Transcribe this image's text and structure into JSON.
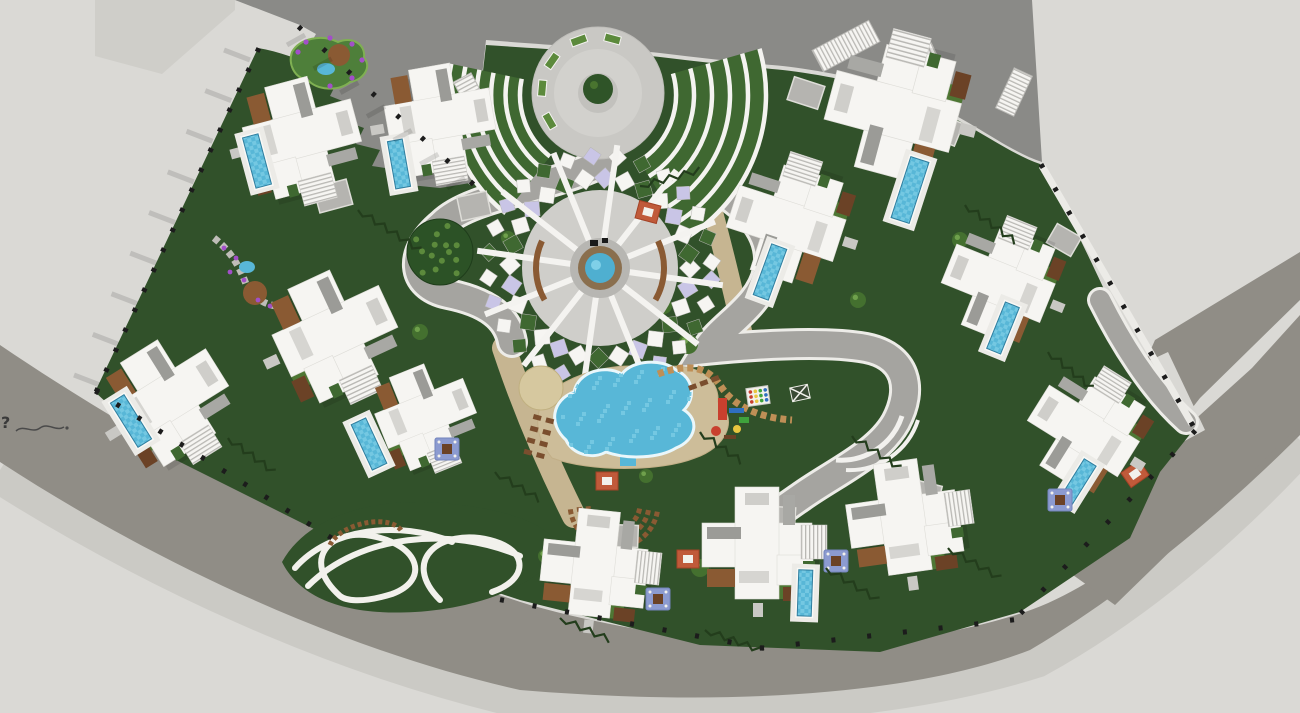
{
  "meta": {
    "view": "aerial-site-plan",
    "description": "Top-down 3D render of a fan-shaped villa resort master plan with central clubhouse, lagoon pool, playground, entry plaza and perimeter ring roads"
  },
  "annotation": {
    "stray_text": "?"
  },
  "palette": {
    "ground": "#DAD9D5",
    "paved_tl": "#CFCEC9",
    "road_dark": "#8A8A87",
    "road_bottom": "#908D86",
    "road_mid": "#A5A4A0",
    "road_light": "#CBCAC5",
    "green": "#31512A",
    "lawn": "#4E7734",
    "lawn_bright": "#5C8A3C",
    "planting": "#3F6831",
    "white": "#F6F5F2",
    "roof_gray": "#CFCECA",
    "roof_dark": "#9B9B97",
    "wall_white": "#ECEBE7",
    "pool": "#58B7D7",
    "pool_light": "#74C8E2",
    "pool_edge": "#2F7D9E",
    "sand": "#CDBD99",
    "tan_path": "#C6B591",
    "deck": "#8A5A33",
    "deck_dark": "#6B4226",
    "hedge": "#233D1C",
    "purple": "#A24FC8",
    "lavender": "#C9C5E6",
    "red": "#C8402E",
    "blue": "#2F6FBF",
    "ply_green": "#3FA23C",
    "yellow": "#E8C63F",
    "fence": "#1C1C1C",
    "jacuzzi": "#8C9BD0",
    "cabana": "#C05A3A"
  },
  "scene": {
    "paved_tl_d": "M95,0 L235,0 L235,10 L162,74 L95,56 Z",
    "roads": {
      "top_d": "M235,0 L1032,0 L1042,162 C1004,150 962,112 908,94 C856,76 806,68 772,65 C738,62 700,58 660,53 C620,49 560,46 486,40 L470,183 L440,188 L420,186 L392,184 L398,170 L372,166 L380,150 L356,144 L364,128 L342,120 L350,104 L330,96 L338,80 L318,72 L326,57 L308,48 L316,34 L300,25 Z",
      "bottom_d": "M0,345 C170,460 340,545 530,605 C700,652 880,660 1025,612 C1135,575 1235,455 1300,390 L1300,435 C1240,495 1140,585 1030,650 C900,700 700,705 520,690 C340,650 150,560 0,462 Z",
      "shoulder_d": "M0,470 C150,565 330,650 520,695 C700,712 900,698 1035,655 C1150,592 1245,500 1300,440",
      "diag_bands": [
        [
          [
            1155,
            340
          ],
          [
            1300,
            252
          ],
          [
            1300,
            300
          ],
          [
            1200,
            398
          ],
          [
            1085,
            545
          ],
          [
            1078,
            515
          ]
        ],
        [
          [
            1252,
            368
          ],
          [
            1300,
            315
          ],
          [
            1300,
            425
          ],
          [
            1115,
            605
          ],
          [
            1045,
            555
          ]
        ]
      ],
      "driveway_pad": [
        [
          1108,
          380
        ],
        [
          1168,
          352
        ],
        [
          1205,
          430
        ],
        [
          1135,
          468
        ]
      ],
      "inner": [
        {
          "d": "M600,164 C545,190 470,196 442,224 C408,252 410,286 448,294 C488,302 508,318 512,342",
          "w": 26
        },
        {
          "d": "M666,164 C738,192 776,228 768,270 C760,308 722,324 706,350 C744,346 822,340 866,348 C906,356 914,388 896,422 C878,454 836,472 802,496 C782,510 770,518 758,530",
          "w": 26
        },
        {
          "d": "M1100,300 C1120,340 1150,390 1186,422",
          "w": 20
        }
      ],
      "curbs": [
        {
          "d": "M836,460 A64,64 0 0 0 902,416",
          "w": 5
        },
        {
          "d": "M846,470 A72,72 0 0 0 918,420",
          "w": 4
        }
      ]
    },
    "site": {
      "green_d": "M258,48 C330,60 400,120 470,185 L486,45 C560,50 620,53 660,57 C700,62 740,66 772,69 C806,72 856,80 908,98 C962,116 1004,152 1040,164 C1062,200 1092,262 1125,335 L1195,428 L1160,472 L1130,538 L1020,612 L880,652 L700,645 L520,600 L330,537 L160,452 L95,392 Z",
      "island_d": "M282,562 C310,512 380,498 440,503 C505,508 545,522 562,548 C540,585 480,608 415,612 C345,616 300,598 282,562 Z",
      "island_loops": [
        "M295,568 C330,528 400,520 452,542",
        "M308,586 C360,534 452,526 520,556",
        "M340,596 C300,560 330,528 372,536 C420,545 430,580 392,594 C360,604 345,600 340,596",
        "M440,600 C400,560 440,528 490,540 C530,550 528,580 492,592"
      ],
      "island_arc": "M330,545 A38,20 -15 0 1 402,532",
      "east_wall": [
        1042,
        166,
        1192,
        424
      ]
    },
    "plaza": {
      "cx": 598,
      "cy": 93,
      "r": 66,
      "planter_angles": [
        150,
        185,
        215,
        250,
        285
      ]
    },
    "wings": [
      {
        "cx": 598,
        "cy": 95,
        "a0": 128,
        "a1": 192,
        "r0": 78,
        "r1": 150,
        "n": 5
      },
      {
        "cx": 598,
        "cy": 95,
        "a0": -16,
        "a1": 58,
        "r0": 78,
        "r1": 168,
        "n": 5
      }
    ],
    "clubhouse": {
      "cx": 600,
      "cy": 268,
      "r_ground": 78,
      "spokes": 12,
      "tile_step": 13
    },
    "lagoon": {
      "sand_d": "M552,458 C530,430 534,400 560,385 C585,370 620,362 655,368 C695,360 720,378 718,402 C740,420 725,448 695,458 C660,472 590,472 552,458 Z",
      "pool_d": "M566,440 C548,424 552,400 574,392 C578,372 604,364 622,374 C632,360 662,358 676,370 C694,378 696,398 684,410 C700,420 696,440 676,448 C660,458 628,460 606,452 C592,460 572,454 566,440 Z",
      "stub": [
        620,
        448,
        16,
        18
      ],
      "patio": [
        541,
        388,
        22
      ]
    },
    "promenades": [
      {
        "d": "M504,348 C522,402 544,456 574,516",
        "w": 24
      },
      {
        "d": "M702,174 C716,220 728,268 744,340",
        "w": 20
      }
    ],
    "trail": {
      "d": "M658,374 C696,360 712,372 722,388 C736,408 762,418 792,420",
      "w": 7
    },
    "sun_deck": {
      "cx": 614,
      "cy": 504,
      "radii": [
        26,
        35,
        44
      ],
      "a0": 10,
      "a1": 175
    },
    "gardens": {
      "tl_blob_d": "M292,52 C300,38 322,34 338,42 C352,36 366,44 364,58 C372,66 364,80 350,82 C338,92 316,90 308,80 C294,78 288,64 292,52 Z",
      "tl_pond": [
        326,
        69,
        9,
        6
      ],
      "tl_mulch": [
        339,
        55,
        11
      ],
      "tl_flowers": [
        [
          298,
          52
        ],
        [
          306,
          42
        ],
        [
          330,
          38
        ],
        [
          352,
          44
        ],
        [
          362,
          60
        ],
        [
          352,
          78
        ],
        [
          330,
          86
        ],
        [
          306,
          80
        ]
      ],
      "left_stone_d": "M214,238 C232,252 240,268 246,284 C254,300 270,308 286,306",
      "left_pond": [
        247,
        267,
        8,
        6
      ],
      "left_mulch": [
        255,
        293,
        12
      ],
      "left_flowers": [
        [
          224,
          248
        ],
        [
          236,
          258
        ],
        [
          230,
          272
        ],
        [
          244,
          280
        ],
        [
          258,
          300
        ],
        [
          270,
          306
        ]
      ]
    },
    "tree_big": [
      440,
      252,
      33
    ],
    "bushes": [
      [
        688,
        344,
        10
      ],
      [
        664,
        306,
        8
      ],
      [
        584,
        300,
        8
      ],
      [
        646,
        476,
        7
      ],
      [
        700,
        568,
        9
      ],
      [
        858,
        300,
        8
      ],
      [
        545,
        556,
        7
      ],
      [
        420,
        332,
        8
      ],
      [
        508,
        238,
        7
      ],
      [
        960,
        240,
        8
      ]
    ],
    "villas": [
      [
        300,
        135,
        75,
        1.0
      ],
      [
        438,
        118,
        80,
        0.95
      ],
      [
        333,
        332,
        65,
        1.05
      ],
      [
        168,
        398,
        58,
        1.0
      ],
      [
        424,
        414,
        68,
        0.85
      ],
      [
        895,
        112,
        -75,
        1.15
      ],
      [
        788,
        224,
        -72,
        1.0
      ],
      [
        1000,
        284,
        -68,
        0.95
      ],
      [
        1085,
        432,
        -58,
        0.95
      ],
      [
        594,
        565,
        6,
        0.95
      ],
      [
        757,
        545,
        0,
        1.0
      ],
      [
        903,
        519,
        -8,
        1.0
      ]
    ],
    "pools": [
      [
        257,
        161,
        75,
        52,
        16
      ],
      [
        399,
        164,
        80,
        48,
        15
      ],
      [
        369,
        444,
        65,
        50,
        16
      ],
      [
        131,
        421,
        58,
        52,
        16
      ],
      [
        910,
        190,
        -72,
        64,
        19
      ],
      [
        770,
        272,
        -70,
        54,
        16
      ],
      [
        1003,
        328,
        -68,
        50,
        15
      ],
      [
        1078,
        482,
        -58,
        46,
        14
      ],
      [
        805,
        593,
        -88,
        46,
        14
      ]
    ],
    "jacuzzis": [
      [
        447,
        449
      ],
      [
        658,
        599
      ],
      [
        836,
        561
      ],
      [
        1060,
        500
      ]
    ],
    "cabanas": [
      [
        648,
        212,
        15
      ],
      [
        607,
        481,
        0
      ],
      [
        688,
        559,
        0
      ],
      [
        1135,
        474,
        -35
      ]
    ],
    "pergolas": [
      [
        846,
        46,
        -28,
        64,
        24
      ],
      [
        916,
        60,
        -25,
        42,
        18
      ],
      [
        472,
        96,
        62,
        42,
        20
      ],
      [
        1014,
        92,
        -65,
        44,
        20
      ]
    ],
    "driveways": [
      [
        333,
        196,
        75,
        26,
        34
      ],
      [
        474,
        206,
        78,
        24,
        30
      ],
      [
        806,
        93,
        -72,
        24,
        32
      ],
      [
        944,
        129,
        -68,
        24,
        32
      ],
      [
        1064,
        240,
        -60,
        22,
        28
      ],
      [
        624,
        536,
        92,
        22,
        28
      ],
      [
        782,
        518,
        -86,
        22,
        26
      ],
      [
        927,
        494,
        -76,
        22,
        26
      ]
    ],
    "hedges": [
      [
        358,
        210,
        420,
        250
      ],
      [
        640,
        186,
        700,
        170
      ],
      [
        700,
        432,
        742,
        462
      ],
      [
        852,
        436,
        900,
        468
      ],
      [
        965,
        205,
        1016,
        242
      ],
      [
        1048,
        352,
        1092,
        388
      ],
      [
        826,
        568,
        878,
        600
      ],
      [
        948,
        548,
        1000,
        578
      ],
      [
        495,
        472,
        540,
        500
      ],
      [
        228,
        438,
        274,
        472
      ],
      [
        705,
        630,
        760,
        650
      ],
      [
        560,
        618,
        610,
        640
      ]
    ],
    "fences": [
      {
        "from": [
          258,
          50
        ],
        "to": [
          97,
          390
        ],
        "n": 18
      },
      {
        "from": [
          97,
          392
        ],
        "to": [
          330,
          537
        ],
        "n": 12
      },
      {
        "from": [
          300,
          28
        ],
        "to": [
          472,
          183
        ],
        "n": 8
      },
      {
        "from": [
          1042,
          166
        ],
        "to": [
          1192,
          424
        ],
        "n": 12
      },
      {
        "from": [
          1022,
          612
        ],
        "to": [
          1194,
          432
        ],
        "n": 9
      },
      {
        "from": [
          502,
          600
        ],
        "to": [
          762,
          648
        ],
        "n": 9
      },
      {
        "from": [
          762,
          648
        ],
        "to": [
          1012,
          620
        ],
        "n": 8
      }
    ],
    "hatches": [
      {
        "from": [
          250,
          60
        ],
        "to": [
          100,
          385
        ],
        "n": 9,
        "dx": -26,
        "dy": -10
      },
      {
        "from": [
          305,
          35
        ],
        "to": [
          465,
          178
        ],
        "n": 7,
        "dx": -18,
        "dy": 10
      }
    ],
    "loungers": {
      "grid": {
        "x": 534,
        "y": 414,
        "cols": 2,
        "rows": 4,
        "dx": 13,
        "dy": 12,
        "rot": 15
      },
      "row": {
        "x": 688,
        "y": 386,
        "n": 3,
        "dx": 12,
        "rot": -20
      }
    },
    "playground": {
      "items": [
        [
          "rect",
          718,
          398,
          9,
          22,
          "red"
        ],
        [
          "rect",
          729,
          408,
          15,
          5,
          "blue"
        ],
        [
          "rect",
          739,
          417,
          10,
          6,
          "ply_green"
        ],
        [
          "circle",
          716,
          431,
          5,
          "red"
        ],
        [
          "circle",
          737,
          429,
          4,
          "yellow"
        ],
        [
          "rect",
          724,
          435,
          12,
          4,
          "deck_dark"
        ]
      ]
    },
    "mats": [
      {
        "x": 758,
        "y": 396,
        "rot": -8,
        "type": "dots"
      },
      {
        "x": 800,
        "y": 393,
        "rot": -12,
        "type": "cross"
      }
    ],
    "scribble_d": "M16,431 C24,424 32,434 40,428 C48,422 56,432 64,427"
  }
}
